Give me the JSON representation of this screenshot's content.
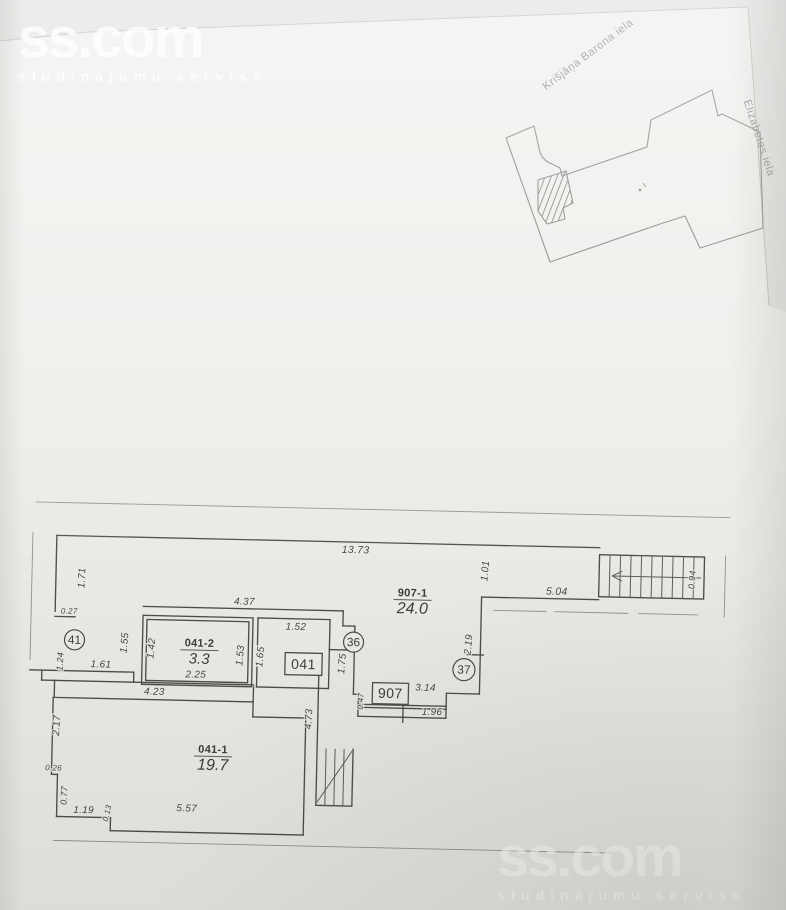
{
  "watermark": {
    "brand": "ss.com",
    "tagline": "sludinājumu serviss"
  },
  "site_plan": {
    "streets": [
      {
        "name": "Krišjāņa Barona iela",
        "x": 590,
        "y": 57,
        "rot": -37
      },
      {
        "name": "Elizabetes iela",
        "x": 756,
        "y": 139,
        "rot": 72
      }
    ]
  },
  "floor_plan": {
    "rooms": [
      {
        "code": "041-2",
        "area": "3.3",
        "x": 202,
        "y": 643,
        "cs": 11,
        "as": 15
      },
      {
        "code": "041-1",
        "area": "19.7",
        "x": 218,
        "y": 749,
        "cs": 11,
        "as": 16
      },
      {
        "code": "907-1",
        "area": "24.0",
        "x": 414,
        "y": 588,
        "cs": 11,
        "as": 16
      }
    ],
    "circle_refs": [
      {
        "v": "41",
        "x": 77,
        "y": 639,
        "rad": 10
      },
      {
        "v": "36",
        "x": 356,
        "y": 635,
        "rad": 10
      },
      {
        "v": "37",
        "x": 467,
        "y": 660,
        "rad": 11
      }
    ],
    "box_refs": [
      {
        "v": "041",
        "x": 288,
        "y": 647,
        "w": 37,
        "h": 22
      },
      {
        "v": "907",
        "x": 376,
        "y": 675,
        "w": 36,
        "h": 21
      }
    ],
    "dimensions": [
      {
        "v": "13.73",
        "x": 356,
        "y": 546,
        "r": 0,
        "s": 10.5
      },
      {
        "v": "1.71",
        "x": 86,
        "y": 577,
        "r": -88,
        "s": 10
      },
      {
        "v": "0.27",
        "x": 71,
        "y": 613,
        "r": 0,
        "s": 8
      },
      {
        "v": "1.24",
        "x": 66,
        "y": 661,
        "r": -88,
        "s": 9
      },
      {
        "v": "1.61",
        "x": 104,
        "y": 666,
        "r": 0,
        "s": 10
      },
      {
        "v": "1.55",
        "x": 130,
        "y": 641,
        "r": -86,
        "s": 10
      },
      {
        "v": "1.42",
        "x": 157,
        "y": 646,
        "r": -86,
        "s": 10
      },
      {
        "v": "1.53",
        "x": 246,
        "y": 651,
        "r": -86,
        "s": 10
      },
      {
        "v": "1.65",
        "x": 266,
        "y": 652,
        "r": -86,
        "s": 10
      },
      {
        "v": "1.52",
        "x": 298,
        "y": 624,
        "r": 0,
        "s": 10
      },
      {
        "v": "4.37",
        "x": 246,
        "y": 600,
        "r": 0,
        "s": 10
      },
      {
        "v": "2.25",
        "x": 199,
        "y": 674,
        "r": 0,
        "s": 10
      },
      {
        "v": "4.23",
        "x": 158,
        "y": 692,
        "r": 0,
        "s": 10
      },
      {
        "v": "2.17",
        "x": 64,
        "y": 725,
        "r": -88,
        "s": 10
      },
      {
        "v": "0.26",
        "x": 59,
        "y": 770,
        "r": 0,
        "s": 8
      },
      {
        "v": "0.77",
        "x": 73,
        "y": 795,
        "r": -88,
        "s": 9
      },
      {
        "v": "1.19",
        "x": 90,
        "y": 812,
        "r": 0,
        "s": 10
      },
      {
        "v": "0.13",
        "x": 116,
        "y": 812,
        "r": -78,
        "s": 8
      },
      {
        "v": "5.57",
        "x": 193,
        "y": 808,
        "r": 0,
        "s": 10
      },
      {
        "v": "4.73",
        "x": 316,
        "y": 713,
        "r": -88,
        "s": 10
      },
      {
        "v": "1.75",
        "x": 348,
        "y": 657,
        "r": -86,
        "s": 10
      },
      {
        "v": "0.47",
        "x": 367,
        "y": 694,
        "r": -88,
        "s": 8
      },
      {
        "v": "3.14",
        "x": 429,
        "y": 682,
        "r": 0,
        "s": 10
      },
      {
        "v": "1.96",
        "x": 436,
        "y": 706,
        "r": 0,
        "s": 10
      },
      {
        "v": "2.19",
        "x": 474,
        "y": 635,
        "r": -86,
        "s": 10
      },
      {
        "v": "1.01",
        "x": 489,
        "y": 561,
        "r": -86,
        "s": 10
      },
      {
        "v": "5.04",
        "x": 558,
        "y": 583,
        "r": 0,
        "s": 10.5
      },
      {
        "v": "0.94",
        "x": 696,
        "y": 565,
        "r": -87,
        "s": 9
      }
    ]
  },
  "colors": {
    "paper": "#e9e8e4",
    "ink": "#44433f",
    "dim_text": "#3e3c38",
    "watermark": "#ffffff"
  }
}
